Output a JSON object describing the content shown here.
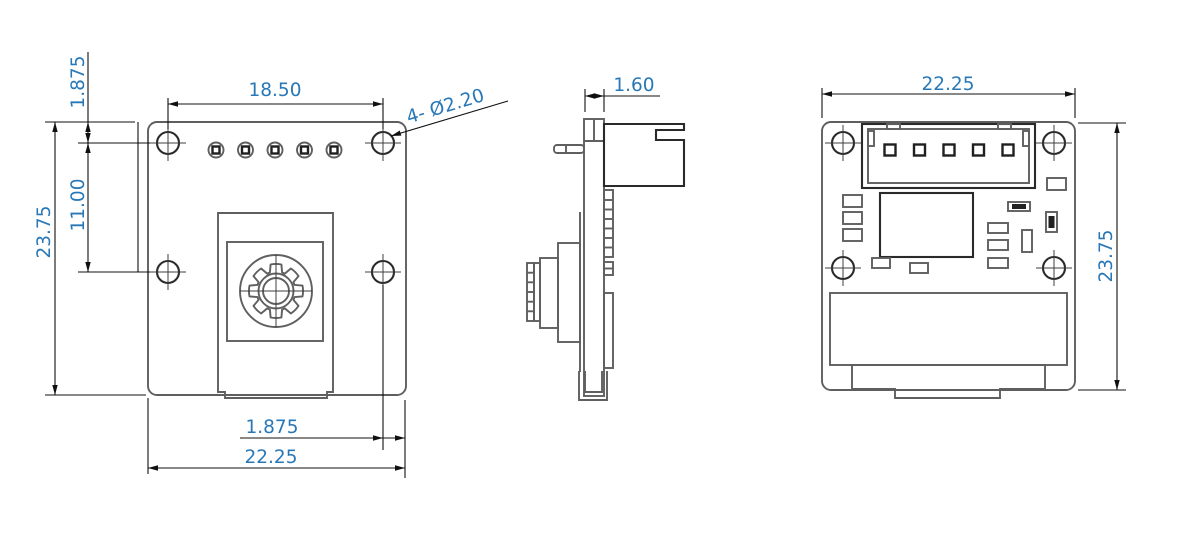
{
  "drawing": {
    "colors": {
      "dimension_text": "#2878b8",
      "geometry_line": "#5f5f5f",
      "dimension_line": "#101010"
    },
    "front": {
      "hole_pitch_h": "18.50",
      "hole_top_offset": "1.875",
      "hole_pitch_v": "11.00",
      "height": "23.75",
      "hole_right_offset": "1.875",
      "width": "22.25",
      "hole_callout": "4- Ø2.20"
    },
    "side": {
      "thickness": "1.60"
    },
    "back": {
      "width": "22.25",
      "height": "23.75"
    }
  }
}
